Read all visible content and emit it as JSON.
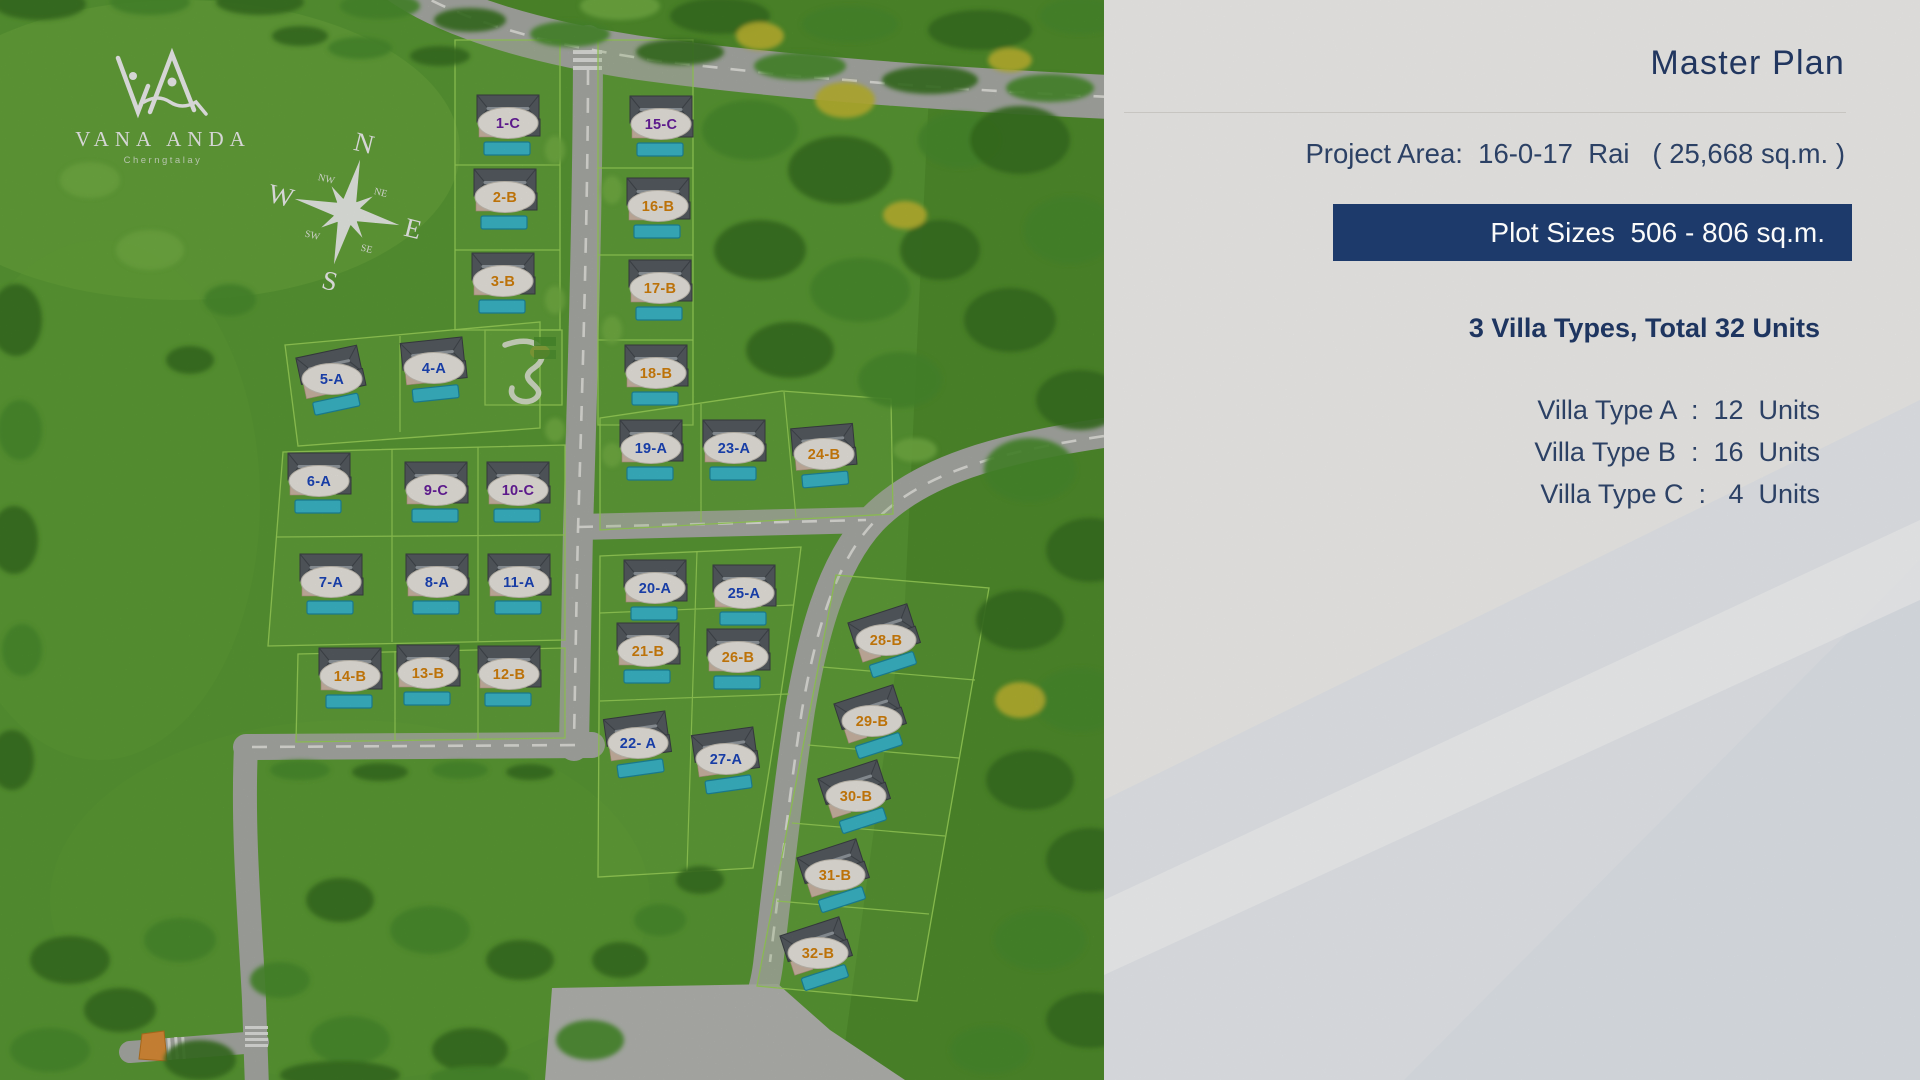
{
  "brand": {
    "name": "VANA ANDA",
    "tagline": "Cherngtalay",
    "monogram": "VA"
  },
  "compass": {
    "n": "N",
    "e": "E",
    "s": "S",
    "w": "W",
    "ne": "NE",
    "se": "SE",
    "sw": "SW",
    "nw": "NW"
  },
  "panel": {
    "title": "Master Plan",
    "project_area_line": "Project Area:  16-0-17  Rai   ( 25,668 sq.m. )",
    "plot_sizes_banner": "Plot Sizes  506 - 806 sq.m.",
    "summary_heading": "3 Villa Types, Total 32 Units",
    "villa_types": [
      "Villa Type A  :  12  Units",
      "Villa Type B  :  16  Units",
      "Villa Type C  :   4  Units"
    ]
  },
  "colors": {
    "type_A": "#1d49c5",
    "type_B": "#e0880b",
    "type_C": "#6e1fa6",
    "banner_bg": "#1d3a6b",
    "navy_text": "#21365f",
    "label_oval": "#f8f5ee",
    "pool": "#3fc3d5",
    "grass": "#5fa337"
  },
  "plots": [
    {
      "label": "1-C",
      "type": "C",
      "x": 508,
      "y": 123,
      "rot": 0
    },
    {
      "label": "2-B",
      "type": "B",
      "x": 505,
      "y": 197,
      "rot": 0
    },
    {
      "label": "3-B",
      "type": "B",
      "x": 503,
      "y": 281,
      "rot": 0
    },
    {
      "label": "4-A",
      "type": "A",
      "x": 434,
      "y": 368,
      "rot": -6
    },
    {
      "label": "5-A",
      "type": "A",
      "x": 332,
      "y": 379,
      "rot": -12
    },
    {
      "label": "6-A",
      "type": "A",
      "x": 319,
      "y": 481,
      "rot": 0
    },
    {
      "label": "7-A",
      "type": "A",
      "x": 331,
      "y": 582,
      "rot": 0
    },
    {
      "label": "8-A",
      "type": "A",
      "x": 437,
      "y": 582,
      "rot": 0
    },
    {
      "label": "9-C",
      "type": "C",
      "x": 436,
      "y": 490,
      "rot": 0
    },
    {
      "label": "10-C",
      "type": "C",
      "x": 518,
      "y": 490,
      "rot": 0
    },
    {
      "label": "11-A",
      "type": "A",
      "x": 519,
      "y": 582,
      "rot": 0
    },
    {
      "label": "12-B",
      "type": "B",
      "x": 509,
      "y": 674,
      "rot": 0
    },
    {
      "label": "13-B",
      "type": "B",
      "x": 428,
      "y": 673,
      "rot": 0
    },
    {
      "label": "14-B",
      "type": "B",
      "x": 350,
      "y": 676,
      "rot": 0
    },
    {
      "label": "15-C",
      "type": "C",
      "x": 661,
      "y": 124,
      "rot": 0
    },
    {
      "label": "16-B",
      "type": "B",
      "x": 658,
      "y": 206,
      "rot": 0
    },
    {
      "label": "17-B",
      "type": "B",
      "x": 660,
      "y": 288,
      "rot": 0
    },
    {
      "label": "18-B",
      "type": "B",
      "x": 656,
      "y": 373,
      "rot": 0
    },
    {
      "label": "19-A",
      "type": "A",
      "x": 651,
      "y": 448,
      "rot": 0
    },
    {
      "label": "20-A",
      "type": "A",
      "x": 655,
      "y": 588,
      "rot": 0
    },
    {
      "label": "21-B",
      "type": "B",
      "x": 648,
      "y": 651,
      "rot": 0
    },
    {
      "label": "22- A",
      "type": "A",
      "x": 638,
      "y": 743,
      "rot": -8
    },
    {
      "label": "23-A",
      "type": "A",
      "x": 734,
      "y": 448,
      "rot": 0
    },
    {
      "label": "24-B",
      "type": "B",
      "x": 824,
      "y": 454,
      "rot": -5
    },
    {
      "label": "25-A",
      "type": "A",
      "x": 744,
      "y": 593,
      "rot": 0
    },
    {
      "label": "26-B",
      "type": "B",
      "x": 738,
      "y": 657,
      "rot": 0
    },
    {
      "label": "27-A",
      "type": "A",
      "x": 726,
      "y": 759,
      "rot": -8
    },
    {
      "label": "28-B",
      "type": "B",
      "x": 886,
      "y": 640,
      "rot": -18
    },
    {
      "label": "29-B",
      "type": "B",
      "x": 872,
      "y": 721,
      "rot": -18
    },
    {
      "label": "30-B",
      "type": "B",
      "x": 856,
      "y": 796,
      "rot": -18
    },
    {
      "label": "31-B",
      "type": "B",
      "x": 835,
      "y": 875,
      "rot": -18
    },
    {
      "label": "32-B",
      "type": "B",
      "x": 818,
      "y": 953,
      "rot": -18
    }
  ]
}
